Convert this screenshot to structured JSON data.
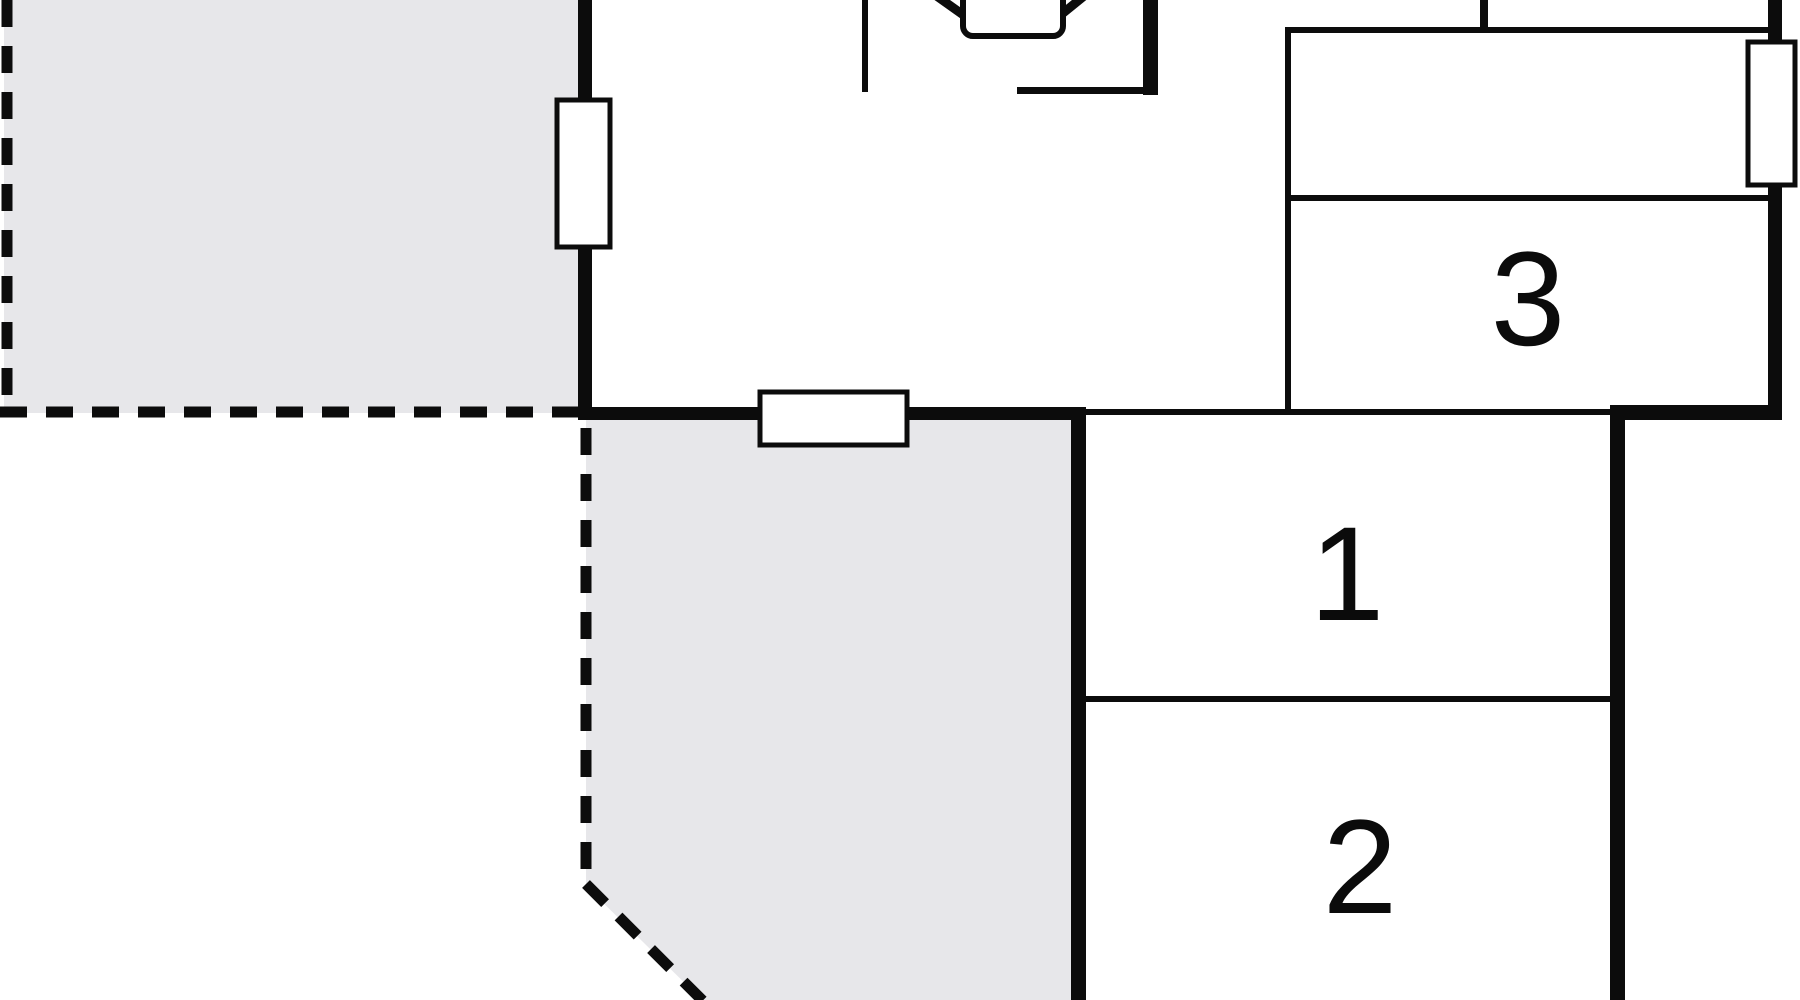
{
  "plan": {
    "background_color": "#ffffff",
    "wall_color": "#0c0c0c",
    "terrace_fill": "#e7e7ea",
    "rooms": [
      {
        "label": "1"
      },
      {
        "label": "2"
      },
      {
        "label": "3"
      }
    ]
  }
}
